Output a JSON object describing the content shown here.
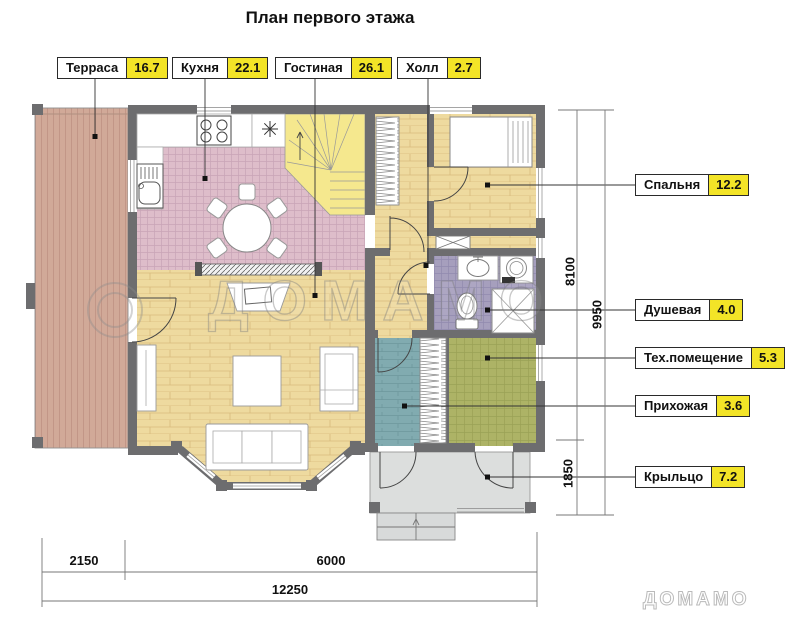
{
  "title": "План первого этажа",
  "top_labels": [
    {
      "name": "Терраса",
      "area": "16.7"
    },
    {
      "name": "Кухня",
      "area": "22.1"
    },
    {
      "name": "Гостиная",
      "area": "26.1"
    },
    {
      "name": "Холл",
      "area": "2.7"
    }
  ],
  "right_labels": [
    {
      "name": "Спальня",
      "area": "12.2"
    },
    {
      "name": "Душевая",
      "area": "4.0"
    },
    {
      "name": "Тех.помещение",
      "area": "5.3"
    },
    {
      "name": "Прихожая",
      "area": "3.6"
    },
    {
      "name": "Крыльцо",
      "area": "7.2"
    }
  ],
  "dimensions": {
    "right_inner_top": "8100",
    "right_outer": "9950",
    "right_inner_bottom": "1850",
    "bottom_left": "2150",
    "bottom_mid": "6000",
    "bottom_total": "12250"
  },
  "watermark": {
    "center": "ДОМАМО",
    "corner": "ДОМАМО"
  },
  "colors": {
    "area_badge": "#f3e427",
    "wall": "#6d6d6f",
    "terrace_floor": "#d0a897",
    "kitchen_tile": "#debdca",
    "wood_floor": "#eeda9f",
    "stairs": "#f5e88e",
    "shower_tile": "#a69fbd",
    "tech_tile": "#adb366",
    "hallway_floor": "#81abb0",
    "porch": "#dcdedd"
  }
}
